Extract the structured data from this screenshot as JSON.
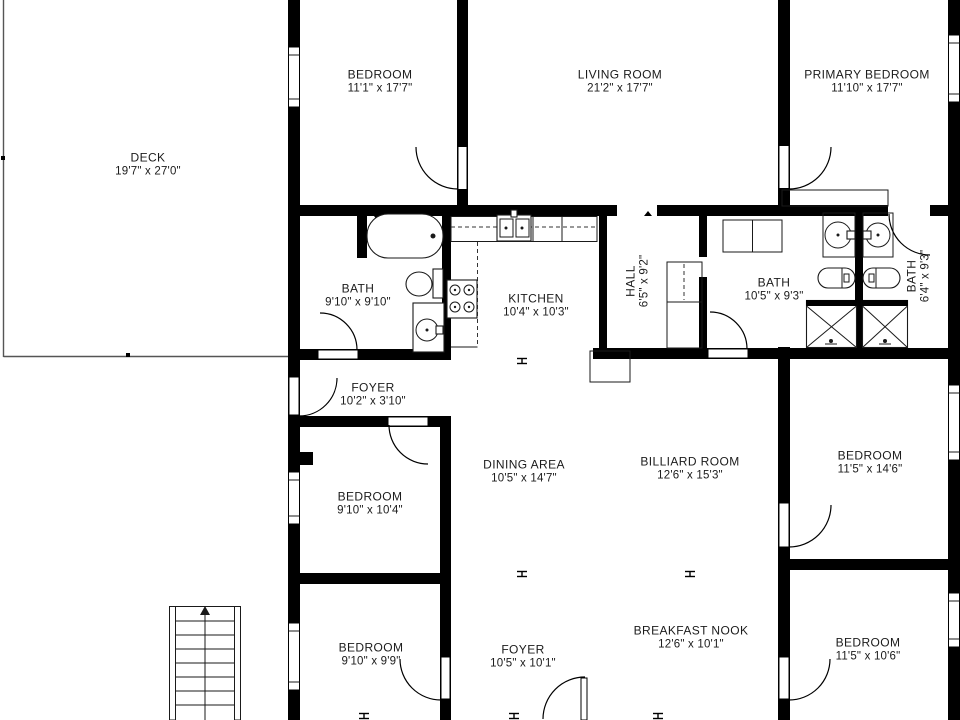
{
  "plan": {
    "background": "#ffffff",
    "wall_color": "#000000",
    "text_color": "#1b1b1b"
  },
  "rooms": [
    {
      "id": "deck",
      "name": "DECK",
      "dims": "19'7\" x 27'0\""
    },
    {
      "id": "bedroom-top",
      "name": "BEDROOM",
      "dims": "11'1\" x 17'7\""
    },
    {
      "id": "living-room",
      "name": "LIVING ROOM",
      "dims": "21'2\" x 17'7\""
    },
    {
      "id": "primary-bedroom",
      "name": "PRIMARY BEDROOM",
      "dims": "11'10\" x 17'7\""
    },
    {
      "id": "bath-main",
      "name": "BATH",
      "dims": "9'10\" x 9'10\""
    },
    {
      "id": "kitchen",
      "name": "KITCHEN",
      "dims": "10'4\" x 10'3\""
    },
    {
      "id": "hall",
      "name": "HALL",
      "dims": "6'5\" x 9'2\""
    },
    {
      "id": "bath-center",
      "name": "BATH",
      "dims": "10'5\" x 9'3\""
    },
    {
      "id": "bath-small",
      "name": "BATH",
      "dims": "6'4\" x 9'3\""
    },
    {
      "id": "foyer-upper",
      "name": "FOYER",
      "dims": "10'2\" x 3'10\""
    },
    {
      "id": "bedroom-mid-left",
      "name": "BEDROOM",
      "dims": "9'10\" x 10'4\""
    },
    {
      "id": "dining-area",
      "name": "DINING AREA",
      "dims": "10'5\" x 14'7\""
    },
    {
      "id": "billiard-room",
      "name": "BILLIARD ROOM",
      "dims": "12'6\" x 15'3\""
    },
    {
      "id": "bedroom-mid-right",
      "name": "BEDROOM",
      "dims": "11'5\" x 14'6\""
    },
    {
      "id": "bedroom-bottom-left",
      "name": "BEDROOM",
      "dims": "9'10\" x 9'9\""
    },
    {
      "id": "foyer-lower",
      "name": "FOYER",
      "dims": "10'5\" x 10'1\""
    },
    {
      "id": "breakfast-nook",
      "name": "BREAKFAST NOOK",
      "dims": "12'6\" x 10'1\""
    },
    {
      "id": "bedroom-bottom-right",
      "name": "BEDROOM",
      "dims": "11'5\" x 10'6\""
    }
  ]
}
